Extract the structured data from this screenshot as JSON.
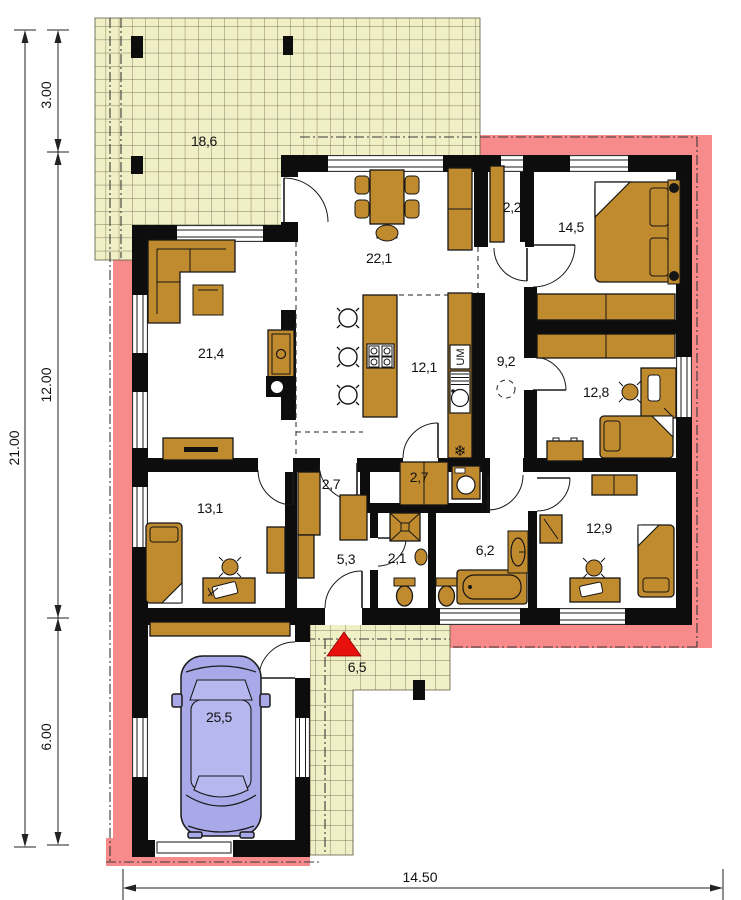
{
  "title": "bungalow-floor-plan",
  "rooms": [
    {
      "id": "terrace",
      "area": "18,6"
    },
    {
      "id": "living-dining",
      "area": "22,1"
    },
    {
      "id": "closet",
      "area": "2,2"
    },
    {
      "id": "bedroom-1",
      "area": "14,5"
    },
    {
      "id": "living-room",
      "area": "21,4"
    },
    {
      "id": "kitchen",
      "area": "12,1"
    },
    {
      "id": "hall",
      "area": "9,2"
    },
    {
      "id": "study",
      "area": "12,8"
    },
    {
      "id": "corridor",
      "area": "2,7"
    },
    {
      "id": "utility",
      "area": "2,7"
    },
    {
      "id": "bedroom-2",
      "area": "13,1"
    },
    {
      "id": "hallway",
      "area": "5,3"
    },
    {
      "id": "wc",
      "area": "2,1"
    },
    {
      "id": "bathroom",
      "area": "6,2"
    },
    {
      "id": "bedroom-3",
      "area": "12,9"
    },
    {
      "id": "porch",
      "area": "6,5"
    },
    {
      "id": "garage",
      "area": "25,5"
    }
  ],
  "appliance_labels": {
    "dishwasher": "UM",
    "freezer": "❄"
  },
  "dimensions": {
    "left_total": "21.00",
    "left_segments": [
      "3.00",
      "12.00",
      "6.00"
    ],
    "bottom_total": "14.50"
  },
  "colors": {
    "paving": "#f1efc5",
    "paving_grid": "#5a563e",
    "band": "#f78b8b",
    "wall": "#0d0d0d",
    "furniture": "#c08a2f",
    "car": "#a9a9ea",
    "entry_marker": "#e8100c"
  }
}
